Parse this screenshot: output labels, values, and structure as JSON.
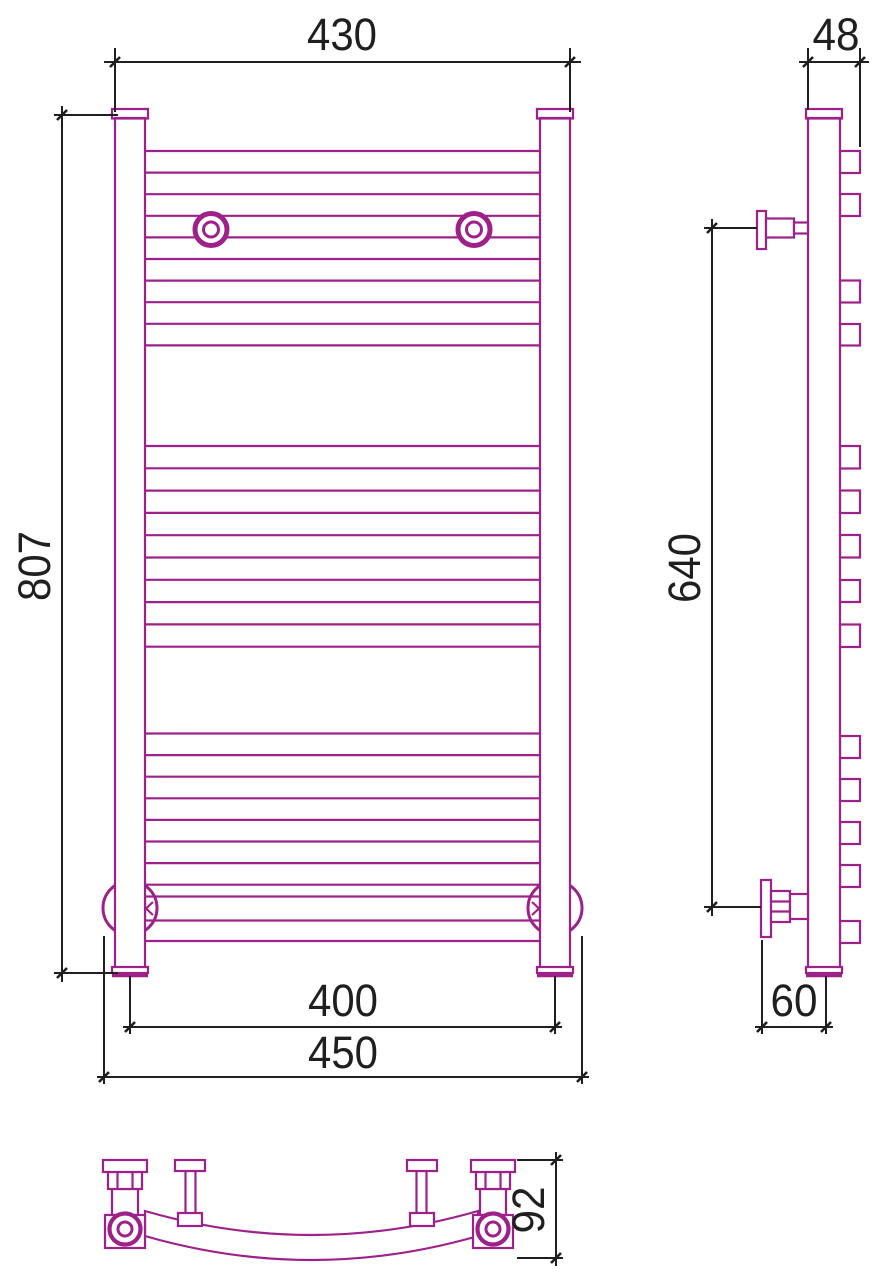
{
  "meta": {
    "type": "technical-drawing",
    "subject": "curved ladder towel radiator - three orthographic views (front, side, bottom)"
  },
  "colors": {
    "product_outline": "#9E2189",
    "dimension_lines": "#1F1F1F",
    "background": "#FFFFFF"
  },
  "dims": {
    "front_width_top": "430",
    "front_height": "807",
    "front_axis_width_bottom": "400",
    "front_overall_width_bottom": "450",
    "side_depth_top": "48",
    "side_mount_span": "640",
    "side_depth_bottom": "60",
    "bottom_view_depth": "92"
  },
  "drawing": {
    "front": {
      "rung_x1": 145,
      "rung_x2": 540,
      "rung_groups": [
        {
          "y": 151.0,
          "count": 10,
          "pitch": 21.6
        },
        {
          "y": 446.0,
          "count": 10,
          "pitch": 22.3
        },
        {
          "y": 733.5,
          "count": 8,
          "pitch": 21.6
        }
      ]
    },
    "side": {
      "stub_x": 840,
      "stub_w": 20,
      "stubs": [
        [
          151,
          173
        ],
        [
          194,
          216
        ],
        [
          280.5,
          302.5
        ],
        [
          324,
          345.5
        ],
        [
          446,
          468.5
        ],
        [
          490.5,
          513
        ],
        [
          535,
          557.5
        ],
        [
          580,
          602
        ],
        [
          624.5,
          647
        ],
        [
          736,
          758
        ],
        [
          779,
          801
        ],
        [
          822,
          844
        ],
        [
          865,
          887
        ],
        [
          921,
          943
        ]
      ]
    }
  }
}
